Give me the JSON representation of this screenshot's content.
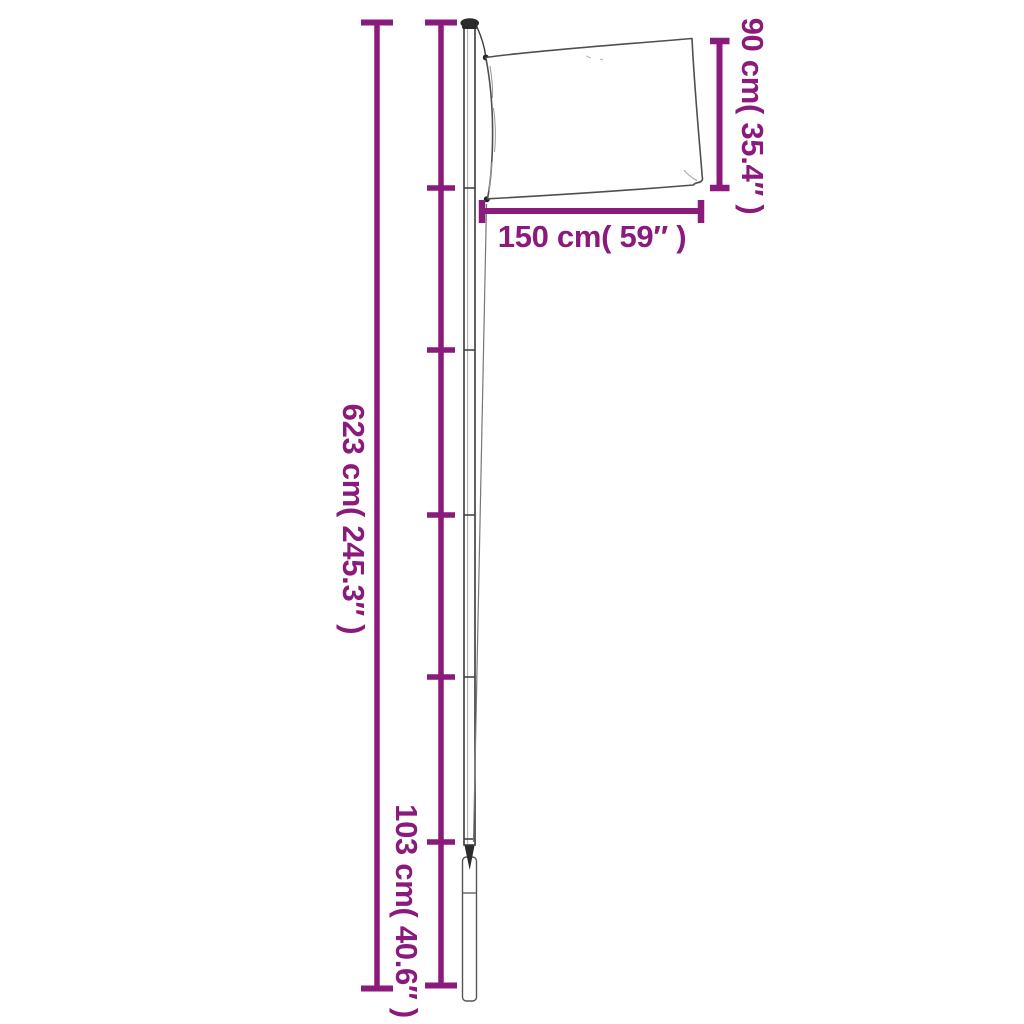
{
  "page": {
    "background_color": "#ffffff",
    "accent_color": "#8A1A7B",
    "drawing_color": "#3a3a3a"
  },
  "diagram": {
    "type": "product-dimension-line-drawing",
    "subject": "telescopic flagpole with flag and ground sleeve",
    "labels": {
      "total_height": "623 cm( 245.3″ )",
      "bottom_section_height": "103 cm( 40.6″ )",
      "flag_width": "150 cm( 59″ )",
      "flag_height": "90 cm( 35.4″ )"
    },
    "measurements": [
      {
        "name": "total pole height",
        "cm": 623,
        "inches": 245.3
      },
      {
        "name": "pole section height",
        "cm": 103,
        "inches": 40.6
      },
      {
        "name": "flag width",
        "cm": 150,
        "inches": 59
      },
      {
        "name": "flag height",
        "cm": 90,
        "inches": 35.4
      }
    ],
    "section_tick_segments": 6
  }
}
